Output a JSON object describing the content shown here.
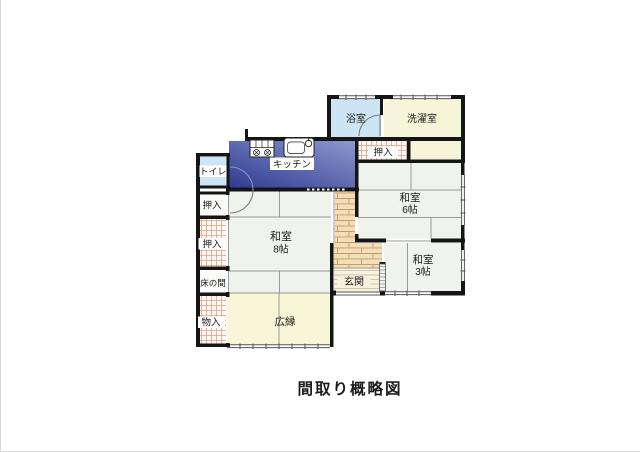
{
  "title": "間取り概略図",
  "colors": {
    "wall": "#151515",
    "kitchen_dark": "#2f3b92",
    "kitchen_light": "#8e98cf",
    "bath_blue": "#cde4f4",
    "cream": "#f6f4d9",
    "tatami": "#f0f2ee",
    "veranda": "#f9f6d8",
    "brick_bg": "#f2debb",
    "brick_line": "#c49d62",
    "checker_bg": "#fdf8f3",
    "checker_line": "#dfa183",
    "stripe_bg": "#f7f1dd",
    "stripe_line": "#c2bda6",
    "thin_line": "#9a9a9a"
  },
  "rooms": {
    "bath": {
      "label": "浴室"
    },
    "laundry": {
      "label": "洗濯室"
    },
    "kitchen": {
      "label": "キッチン"
    },
    "toilet": {
      "label": "トイレ"
    },
    "closet_upper": {
      "label": "押入"
    },
    "closet_left_1": {
      "label": "押入"
    },
    "closet_left_2": {
      "label": "押入"
    },
    "tokonoma": {
      "label": "床の間"
    },
    "storage": {
      "label": "物入"
    },
    "washitsu_8": {
      "label": "和室",
      "size": "8帖"
    },
    "washitsu_6": {
      "label": "和室",
      "size": "6帖"
    },
    "washitsu_3": {
      "label": "和室",
      "size": "3帖"
    },
    "veranda": {
      "label": "広縁"
    },
    "entrance": {
      "label": "玄関"
    }
  }
}
